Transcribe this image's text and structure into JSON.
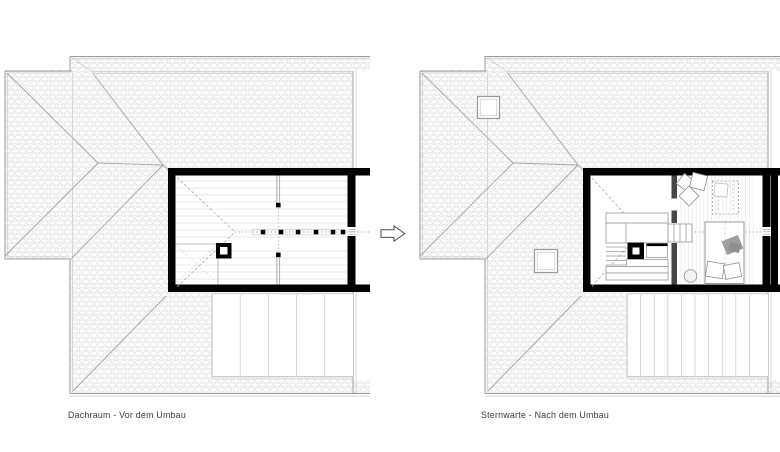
{
  "figure": {
    "title_hidden": "",
    "plans": [
      {
        "id": "before",
        "label": "Dachraum - Vor dem Umbau"
      },
      {
        "id": "after",
        "label": "Sternwarte - Nach dem Umbau"
      }
    ],
    "arrow": {
      "name": "transformation-arrow",
      "direction": "right"
    },
    "colors": {
      "background": "#ffffff",
      "walls": "#000000",
      "roof_lines": "#9a9a9a",
      "shingle_hatch": "#dfdfdf",
      "partition": "#454545",
      "furniture_lines": "#8f8f8f",
      "blanket_fill": "#a0a0a0",
      "label_text": "#3a3a3a"
    }
  }
}
